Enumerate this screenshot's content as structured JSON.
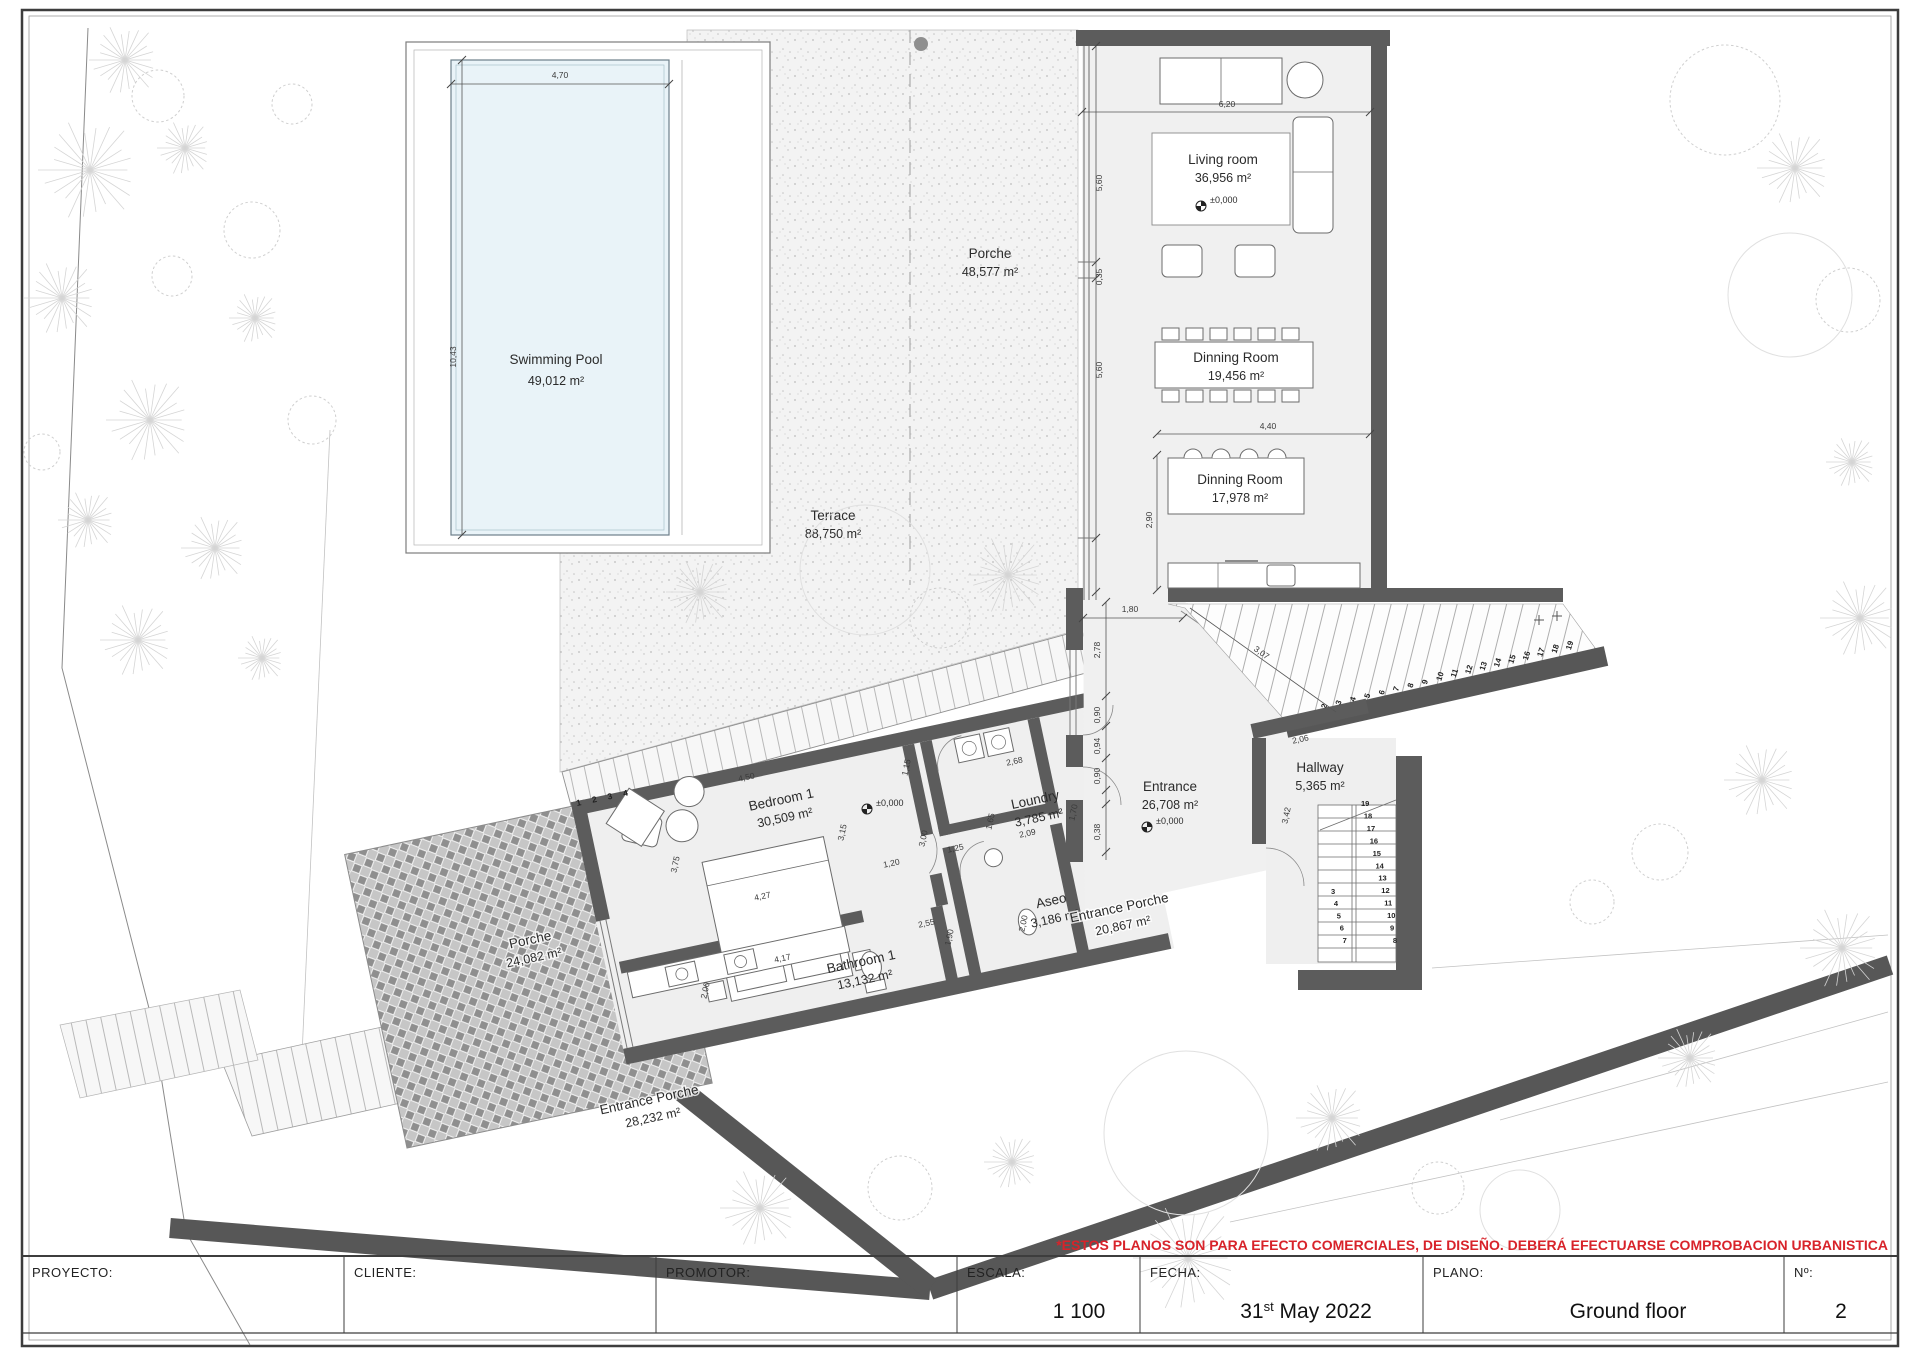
{
  "rooms": {
    "swimming_pool": {
      "name": "Swimming Pool",
      "area": "49,012 m²"
    },
    "porche_top": {
      "name": "Porche",
      "area": "48,577 m²"
    },
    "terrace": {
      "name": "Terrace",
      "area": "88,750 m²"
    },
    "living_room": {
      "name": "Living room",
      "area": "36,956 m²"
    },
    "dinning_room_1": {
      "name": "Dinning Room",
      "area": "19,456 m²"
    },
    "dinning_room_2": {
      "name": "Dinning Room",
      "area": "17,978 m²"
    },
    "entrance": {
      "name": "Entrance",
      "area": "26,708 m²"
    },
    "hallway": {
      "name": "Hallway",
      "area": "5,365 m²"
    },
    "loundry": {
      "name": "Loundry",
      "area": "3,785 m²"
    },
    "aseo": {
      "name": "Aseo",
      "area": "3,186 m²"
    },
    "bedroom_1": {
      "name": "Bedroom 1",
      "area": "30,509 m²"
    },
    "bathroom_1": {
      "name": "Bathroom 1",
      "area": "13,132 m²"
    },
    "entrance_porche_1": {
      "name": "Entrance Porche",
      "area": "20,867 m²"
    },
    "entrance_porche_2": {
      "name": "Entrance Porche",
      "area": "28,232 m²"
    },
    "porche_west": {
      "name": "Porche",
      "area": "24,082 m²"
    }
  },
  "levels": {
    "marker": "±0,000"
  },
  "dims": {
    "pool_w": "4,70",
    "pool_h": "10,43",
    "living_w": "6,20",
    "wing_a": "5,60",
    "wing_b": "0,35",
    "wing_c": "5,60",
    "din2_h": "2,90",
    "din2_w": "4,40",
    "ent_top": "1,80",
    "ent_a": "2,78",
    "ent_b": "0,90",
    "ent_c": "0,94",
    "ent_d": "0,90",
    "ent_e": "0,38",
    "slope": "3,07",
    "hall_w": "2,06",
    "hall_h": "3,42",
    "bed_w": "4,50",
    "bed_h": "3,75",
    "bed_e": "3,15",
    "bed_s": "4,27",
    "bed_r": "1,15",
    "bath_w": "4,17",
    "bath_h": "2,00",
    "lnd_w": "2,68",
    "lnd_s": "2,09",
    "lnd_h": "1,65",
    "lnd_d": "1,70",
    "lnd_b": "1,25",
    "aseo_a": "2,55",
    "aseo_b": "1,90",
    "aseo_c": "1,20",
    "aseo_d": "3,00",
    "aseo_e": "2,00"
  },
  "stairs": {
    "porch_steps": [
      "1",
      "2",
      "3",
      "4"
    ],
    "exterior": [
      "2",
      "3",
      "4",
      "5",
      "6",
      "7",
      "8",
      "9",
      "10",
      "11",
      "12",
      "13",
      "14",
      "15",
      "16",
      "17",
      "18",
      "19"
    ],
    "interior_upper": [
      "19",
      "18",
      "17",
      "16",
      "15",
      "14",
      "13",
      "12",
      "11",
      "10",
      "9",
      "8"
    ],
    "interior_lower": [
      "3",
      "4",
      "5",
      "6",
      "7"
    ]
  },
  "disclaimer": "*ESTOS PLANOS SON PARA EFECTO COMERCIALES, DE DISEÑO. DEBERÁ EFECTUARSE COMPROBACION URBANISTICA",
  "title_block": {
    "proyecto_label": "PROYECTO:",
    "proyecto_value": "",
    "cliente_label": "CLIENTE:",
    "cliente_value": "",
    "promotor_label": "PROMOTOR:",
    "promotor_value": "",
    "escala_label": "ESCALA:",
    "escala_value": "1 100",
    "fecha_label": "FECHA:",
    "fecha_day": "31",
    "fecha_sup": "st",
    "fecha_rest": "  May  2022",
    "plano_label": "PLANO:",
    "plano_value": "Ground floor",
    "num_label": "Nº:",
    "num_value": "2"
  }
}
